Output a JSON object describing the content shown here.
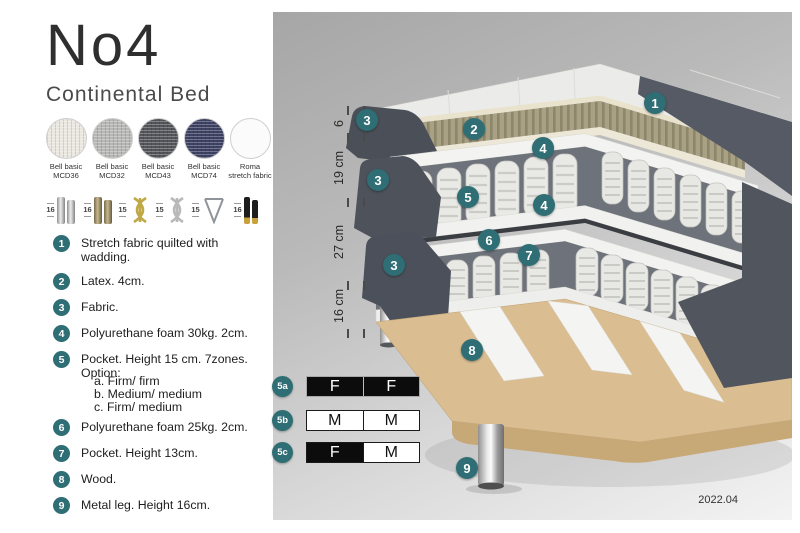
{
  "header": {
    "title": "No4",
    "subtitle": "Continental Bed"
  },
  "fabric_swatches": [
    {
      "line1": "Bell basic",
      "line2": "MCD36",
      "color": "#e9e7e0"
    },
    {
      "line1": "Bell basic",
      "line2": "MCD32",
      "color": "#b7b7b5"
    },
    {
      "line1": "Bell basic",
      "line2": "MCD43",
      "color": "#54555a"
    },
    {
      "line1": "Bell basic",
      "line2": "MCD74",
      "color": "#3d4263"
    },
    {
      "line1": "Roma",
      "line2": "stretch fabric",
      "color": "#fbfbfb"
    }
  ],
  "leg_options": [
    {
      "height": "16",
      "style": "chrome-cylinder"
    },
    {
      "height": "16",
      "style": "wood-cylinder"
    },
    {
      "height": "15",
      "style": "gold-twist"
    },
    {
      "height": "15",
      "style": "silver-twist"
    },
    {
      "height": "15",
      "style": "hairpin"
    },
    {
      "height": "16",
      "style": "black-gold"
    }
  ],
  "parts_list": [
    {
      "num": "1",
      "text": "Stretch fabric quilted with wadding."
    },
    {
      "num": "2",
      "text": "Latex. 4cm."
    },
    {
      "num": "3",
      "text": "Fabric."
    },
    {
      "num": "4",
      "text": "Polyurethane foam 30kg. 2cm."
    },
    {
      "num": "5",
      "text": "Pocket. Height 15 cm. 7zones. Option:",
      "options": [
        "a. Firm/ firm",
        "b. Medium/ medium",
        "c. Firm/ medium"
      ]
    },
    {
      "num": "6",
      "text": "Polyurethane foam 25kg. 2cm."
    },
    {
      "num": "7",
      "text": "Pocket. Height 13cm."
    },
    {
      "num": "8",
      "text": "Wood."
    },
    {
      "num": "9",
      "text": "Metal leg. Height 16cm."
    }
  ],
  "diagram": {
    "dimension_labels": [
      {
        "label": "6"
      },
      {
        "label": "19 cm"
      },
      {
        "label": "27 cm"
      },
      {
        "label": "16 cm"
      }
    ],
    "callouts": [
      {
        "label": "1"
      },
      {
        "label": "2"
      },
      {
        "label": "3"
      },
      {
        "label": "3"
      },
      {
        "label": "3"
      },
      {
        "label": "4"
      },
      {
        "label": "4"
      },
      {
        "label": "5"
      },
      {
        "label": "6"
      },
      {
        "label": "7"
      },
      {
        "label": "8"
      },
      {
        "label": "9"
      }
    ],
    "firmness_options": [
      {
        "id": "5a",
        "left": "F",
        "right": "F",
        "left_bg": "#0c0c0c",
        "left_fg": "#ffffff",
        "right_bg": "#0c0c0c",
        "right_fg": "#ffffff"
      },
      {
        "id": "5b",
        "left": "M",
        "right": "M",
        "left_bg": "#ffffff",
        "left_fg": "#111111",
        "right_bg": "#ffffff",
        "right_fg": "#111111"
      },
      {
        "id": "5c",
        "left": "F",
        "right": "M",
        "left_bg": "#0c0c0c",
        "left_fg": "#ffffff",
        "right_bg": "#ffffff",
        "right_fg": "#111111"
      }
    ],
    "version": "2022.04"
  },
  "colors": {
    "accent_teal": "#2e6e74",
    "bed_dark_fabric": "#4d525b",
    "latex": "#a8a184",
    "wood": "#dabe92",
    "spring_white": "#e9e9e6",
    "frame_white": "#f2f2f0"
  }
}
